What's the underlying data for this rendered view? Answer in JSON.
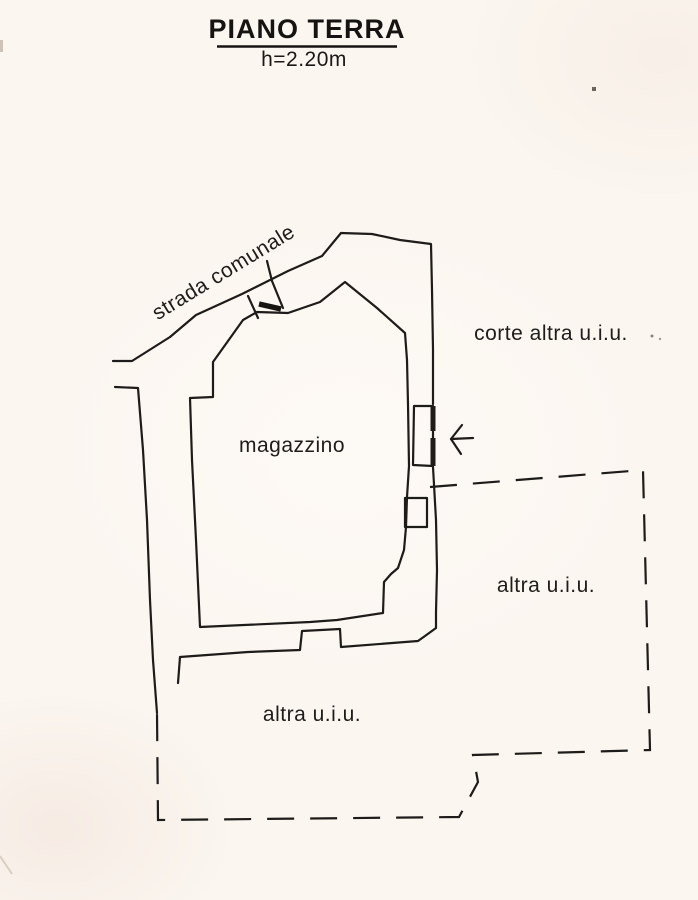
{
  "page": {
    "title": "PIANO TERRA",
    "subtitle": "h=2.20m"
  },
  "labels": {
    "road": "strada comunale",
    "room": "magazzino",
    "courtyard_other_unit": "corte altra u.i.u.",
    "other_unit_right": "altra u.i.u.",
    "other_unit_bottom": "altra u.i.u."
  },
  "colors": {
    "ink": "#1e1c1a",
    "paper": "#fbf6f0"
  }
}
